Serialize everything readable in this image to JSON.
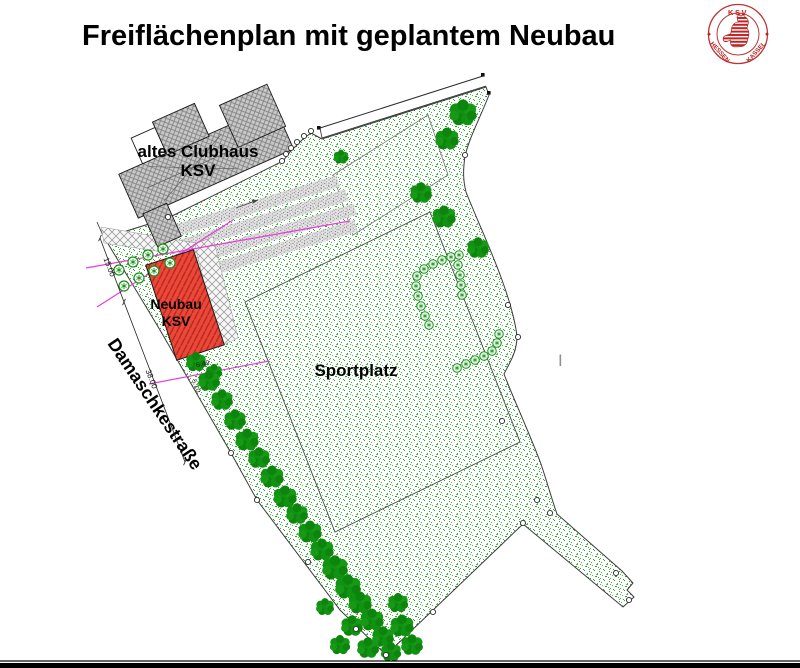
{
  "title": "Freiflächenplan mit geplantem Neubau",
  "logo": {
    "text_top": "KSV",
    "text_left": "HESSEN",
    "text_right": "KASSEL"
  },
  "plan": {
    "old_clubhouse": {
      "line1": "altes Clubhaus",
      "line2": "KSV"
    },
    "new_building": {
      "line1": "Neubau",
      "line2": "KSV"
    },
    "sports_field": "Sportplatz",
    "street": "Damaschkestraße",
    "dimensions": {
      "left_upper": "15.00",
      "left_lower": "38.00",
      "small_a": "6.49",
      "small_b": "5.10"
    },
    "artifact_cursor": "I"
  },
  "colors": {
    "lawn_speck": "#3aa83a",
    "tree_green": "#129212",
    "new_building_red": "#e8493b",
    "building_gray": "#c8c8c8",
    "magenta_line": "#e83bd8",
    "logo_red": "#bb2222",
    "line_black": "#2a2a2a"
  }
}
